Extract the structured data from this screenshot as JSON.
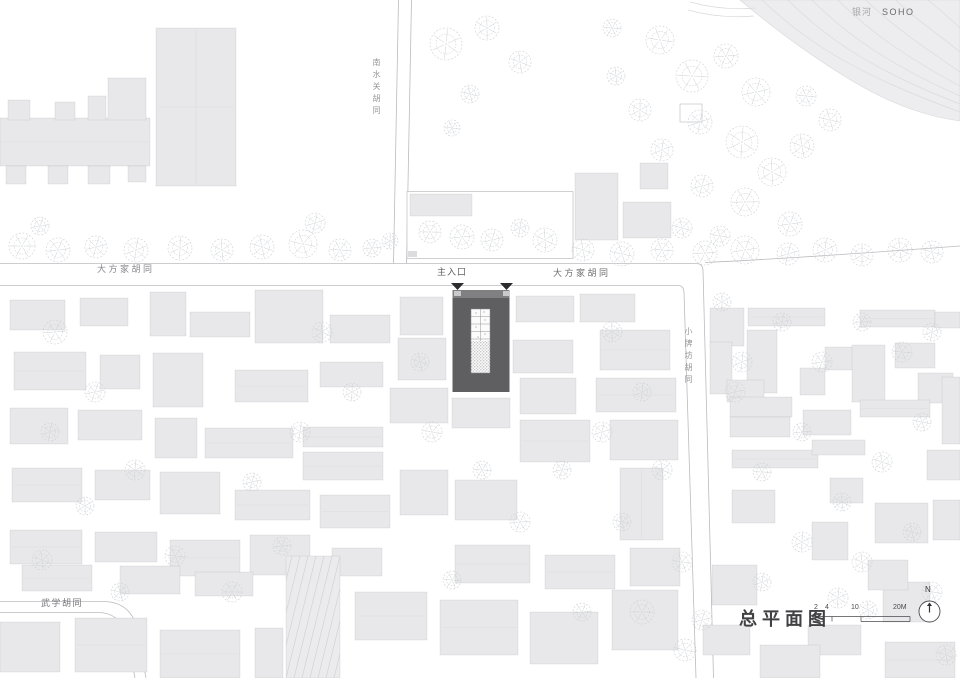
{
  "canvas": {
    "width": 960,
    "height": 678,
    "background": "#ffffff"
  },
  "labels": {
    "soho_cn": "银河",
    "soho_en": "SOHO",
    "street_top_vertical": "南水关胡同",
    "street_left": "大方家胡同",
    "main_entrance": "主入口",
    "street_right": "大方家胡同",
    "street_side_vertical": "小牌坊胡同",
    "street_bottom_left": "武学胡同",
    "title": "总平面图",
    "north": "N"
  },
  "scalebar": {
    "ticks": [
      "2",
      "4",
      "10",
      "20M"
    ]
  },
  "colors": {
    "building": "#e8e8ea",
    "building_stroke": "rgba(110,110,118,0.22)",
    "road_line": "#bcbcc0",
    "tree": "#cdd0d4",
    "site_fill": "#5f5f61",
    "site_top": "#808082",
    "entrance_arrow": "#2b2b2d",
    "courtyard": "#fbfbfb",
    "courtyard_line": "#88888a",
    "stipple_dot": "#8e8e90",
    "soho_fill": "#ededef",
    "soho_line": "#dbdbde",
    "parcel_stroke": "#c5c5c9",
    "hatch_line": "#d2d2d5",
    "annot": "#4a4a4e"
  },
  "map": {
    "roads": [
      "M0,263.5 H697",
      "M0,285.5 H679 Q683.5,286 684,292 L696,678",
      "M697,263.5 Q702.5,264 703,270 L713.5,678",
      "M705,262.5 C780,259 880,252 960,246",
      "M398.5,0 L393.5,263.5",
      "M411.5,0 L406.5,263.5",
      "M0,601.5 H104 Q128,602 136,624 L146,678",
      "M0,612.5 H99 Q118,613 126,632 L135,678"
    ],
    "soho": {
      "area": "M740,0 C790,42 838,74 872,92 C905,109 932,117 960,121 L960,0 Z",
      "lines": [
        "M762,0 C805,40 850,72 960,112",
        "M788,0 C826,38 872,70 960,104",
        "M812,0 C846,34 888,64 960,96",
        "M838,0 C868,30 904,56 960,86",
        "M866,0 C890,24 922,46 960,72",
        "M896,0 C914,18 938,34 960,52",
        "M928,0 C940,10 952,20 960,28",
        "M690,2 C712,8 734,10 756,8",
        "M688,10 C710,16 732,18 754,16"
      ]
    },
    "parcel": {
      "x": 407,
      "y": 191.5,
      "w": 166,
      "h": 67,
      "mark": [
        408,
        251,
        9,
        6
      ]
    },
    "outlined_buildings": [
      [
        680,
        104,
        22,
        18
      ]
    ],
    "hatch_building": {
      "x": 286,
      "y": 556,
      "w": 54,
      "h": 122
    },
    "buildings": [
      [
        156,
        28,
        80,
        158
      ],
      [
        0,
        118,
        150,
        48
      ],
      [
        8,
        100,
        22,
        20
      ],
      [
        55,
        102,
        20,
        18
      ],
      [
        88,
        96,
        18,
        24
      ],
      [
        108,
        78,
        38,
        42
      ],
      [
        6,
        166,
        20,
        18
      ],
      [
        48,
        166,
        20,
        18
      ],
      [
        88,
        166,
        22,
        18
      ],
      [
        128,
        166,
        18,
        16
      ],
      [
        410,
        194,
        62,
        22
      ],
      [
        575,
        173,
        43,
        67
      ],
      [
        623,
        202,
        48,
        36
      ],
      [
        640,
        163,
        28,
        26
      ],
      [
        10,
        300,
        55,
        30
      ],
      [
        80,
        298,
        48,
        28
      ],
      [
        150,
        292,
        36,
        44
      ],
      [
        190,
        312,
        60,
        25
      ],
      [
        255,
        290,
        68,
        53
      ],
      [
        330,
        315,
        60,
        28
      ],
      [
        400,
        297,
        43,
        38
      ],
      [
        398,
        338,
        48,
        42
      ],
      [
        14,
        352,
        72,
        38
      ],
      [
        100,
        355,
        40,
        34
      ],
      [
        153,
        353,
        50,
        54
      ],
      [
        235,
        370,
        73,
        32
      ],
      [
        320,
        362,
        63,
        25
      ],
      [
        390,
        388,
        58,
        35
      ],
      [
        10,
        408,
        58,
        36
      ],
      [
        78,
        410,
        64,
        30
      ],
      [
        155,
        418,
        42,
        40
      ],
      [
        205,
        428,
        88,
        30
      ],
      [
        303,
        427,
        80,
        20
      ],
      [
        303,
        452,
        80,
        28
      ],
      [
        12,
        468,
        70,
        34
      ],
      [
        95,
        470,
        55,
        30
      ],
      [
        160,
        472,
        60,
        42
      ],
      [
        235,
        490,
        75,
        30
      ],
      [
        320,
        495,
        70,
        33
      ],
      [
        400,
        470,
        48,
        45
      ],
      [
        10,
        530,
        72,
        34
      ],
      [
        95,
        532,
        62,
        30
      ],
      [
        170,
        540,
        70,
        36
      ],
      [
        250,
        535,
        60,
        40
      ],
      [
        332,
        548,
        50,
        28
      ],
      [
        22,
        565,
        70,
        26
      ],
      [
        120,
        566,
        60,
        28
      ],
      [
        195,
        572,
        58,
        24
      ],
      [
        0,
        622,
        60,
        50
      ],
      [
        75,
        618,
        72,
        54
      ],
      [
        160,
        630,
        80,
        48
      ],
      [
        255,
        628,
        28,
        50
      ],
      [
        355,
        592,
        72,
        48
      ],
      [
        440,
        600,
        78,
        55
      ],
      [
        530,
        612,
        68,
        52
      ],
      [
        612,
        590,
        66,
        60
      ],
      [
        516,
        296,
        58,
        26
      ],
      [
        580,
        294,
        55,
        28
      ],
      [
        513,
        340,
        60,
        33
      ],
      [
        520,
        378,
        56,
        36
      ],
      [
        600,
        330,
        70,
        40
      ],
      [
        596,
        378,
        80,
        34
      ],
      [
        610,
        420,
        68,
        40
      ],
      [
        520,
        420,
        70,
        42
      ],
      [
        620,
        468,
        43,
        72
      ],
      [
        455,
        480,
        62,
        40
      ],
      [
        455,
        545,
        75,
        38
      ],
      [
        545,
        555,
        70,
        34
      ],
      [
        630,
        548,
        50,
        38
      ],
      [
        452,
        398,
        58,
        30
      ],
      [
        710,
        308,
        34,
        38
      ],
      [
        748,
        308,
        77,
        18
      ],
      [
        860,
        310,
        75,
        17
      ],
      [
        935,
        312,
        25,
        16
      ],
      [
        710,
        342,
        22,
        52
      ],
      [
        747,
        330,
        30,
        63
      ],
      [
        825,
        347,
        30,
        23
      ],
      [
        852,
        345,
        33,
        57
      ],
      [
        895,
        343,
        40,
        25
      ],
      [
        918,
        373,
        35,
        30
      ],
      [
        942,
        377,
        18,
        67
      ],
      [
        727,
        380,
        37,
        22
      ],
      [
        800,
        368,
        25,
        27
      ],
      [
        730,
        397,
        62,
        20
      ],
      [
        803,
        410,
        48,
        25
      ],
      [
        730,
        417,
        60,
        20
      ],
      [
        860,
        400,
        70,
        17
      ],
      [
        732,
        450,
        86,
        18
      ],
      [
        732,
        490,
        43,
        33
      ],
      [
        812,
        440,
        53,
        15
      ],
      [
        830,
        478,
        33,
        25
      ],
      [
        875,
        503,
        53,
        40
      ],
      [
        812,
        522,
        36,
        38
      ],
      [
        883,
        582,
        47,
        40
      ],
      [
        808,
        625,
        53,
        30
      ],
      [
        927,
        450,
        33,
        30
      ],
      [
        933,
        500,
        27,
        40
      ],
      [
        703,
        625,
        47,
        30
      ],
      [
        712,
        565,
        45,
        40
      ],
      [
        760,
        645,
        60,
        33
      ],
      [
        885,
        642,
        70,
        36
      ],
      [
        868,
        560,
        40,
        30
      ]
    ],
    "trees": [
      [
        22,
        246,
        13
      ],
      [
        58,
        250,
        12
      ],
      [
        96,
        247,
        11
      ],
      [
        136,
        250,
        12
      ],
      [
        180,
        248,
        12
      ],
      [
        222,
        250,
        11
      ],
      [
        262,
        247,
        12
      ],
      [
        303,
        244,
        14
      ],
      [
        340,
        250,
        11
      ],
      [
        372,
        248,
        9
      ],
      [
        40,
        226,
        9
      ],
      [
        315,
        223,
        10
      ],
      [
        446,
        44,
        16
      ],
      [
        487,
        28,
        12
      ],
      [
        520,
        62,
        11
      ],
      [
        470,
        94,
        9
      ],
      [
        452,
        128,
        8
      ],
      [
        430,
        232,
        11
      ],
      [
        462,
        237,
        12
      ],
      [
        492,
        240,
        11
      ],
      [
        520,
        228,
        9
      ],
      [
        390,
        241,
        8
      ],
      [
        545,
        240,
        12
      ],
      [
        583,
        250,
        11
      ],
      [
        622,
        254,
        12
      ],
      [
        662,
        250,
        11
      ],
      [
        705,
        253,
        12
      ],
      [
        745,
        250,
        14
      ],
      [
        788,
        254,
        11
      ],
      [
        825,
        250,
        12
      ],
      [
        862,
        255,
        11
      ],
      [
        900,
        250,
        12
      ],
      [
        932,
        252,
        11
      ],
      [
        660,
        40,
        14
      ],
      [
        692,
        76,
        16
      ],
      [
        726,
        56,
        12
      ],
      [
        756,
        92,
        14
      ],
      [
        700,
        122,
        12
      ],
      [
        742,
        142,
        16
      ],
      [
        772,
        172,
        14
      ],
      [
        802,
        146,
        12
      ],
      [
        830,
        120,
        11
      ],
      [
        806,
        96,
        10
      ],
      [
        745,
        202,
        14
      ],
      [
        790,
        224,
        12
      ],
      [
        702,
        186,
        11
      ],
      [
        662,
        150,
        11
      ],
      [
        640,
        110,
        11
      ],
      [
        616,
        76,
        9
      ],
      [
        682,
        228,
        10
      ],
      [
        720,
        236,
        10
      ],
      [
        612,
        28,
        9
      ],
      [
        55,
        332,
        12
      ],
      [
        95,
        392,
        10
      ],
      [
        50,
        432,
        9
      ],
      [
        135,
        470,
        10
      ],
      [
        85,
        506,
        9
      ],
      [
        42,
        560,
        10
      ],
      [
        120,
        592,
        9
      ],
      [
        175,
        556,
        10
      ],
      [
        232,
        592,
        10
      ],
      [
        282,
        546,
        9
      ],
      [
        252,
        482,
        9
      ],
      [
        300,
        432,
        10
      ],
      [
        352,
        392,
        9
      ],
      [
        322,
        332,
        10
      ],
      [
        420,
        362,
        9
      ],
      [
        432,
        432,
        10
      ],
      [
        482,
        470,
        9
      ],
      [
        520,
        522,
        10
      ],
      [
        562,
        470,
        9
      ],
      [
        602,
        432,
        10
      ],
      [
        642,
        392,
        9
      ],
      [
        612,
        332,
        10
      ],
      [
        662,
        470,
        10
      ],
      [
        622,
        522,
        9
      ],
      [
        682,
        562,
        10
      ],
      [
        642,
        612,
        12
      ],
      [
        582,
        612,
        9
      ],
      [
        702,
        620,
        10
      ],
      [
        762,
        582,
        9
      ],
      [
        802,
        542,
        10
      ],
      [
        842,
        502,
        9
      ],
      [
        882,
        462,
        10
      ],
      [
        922,
        422,
        9
      ],
      [
        902,
        352,
        10
      ],
      [
        862,
        322,
        9
      ],
      [
        822,
        362,
        10
      ],
      [
        782,
        322,
        9
      ],
      [
        742,
        362,
        10
      ],
      [
        722,
        302,
        9
      ],
      [
        862,
        562,
        10
      ],
      [
        912,
        532,
        9
      ],
      [
        932,
        592,
        10
      ],
      [
        762,
        472,
        9
      ],
      [
        802,
        432,
        9
      ],
      [
        735,
        392,
        10
      ],
      [
        932,
        332,
        9
      ],
      [
        838,
        598,
        10
      ],
      [
        868,
        610,
        9
      ],
      [
        946,
        655,
        10
      ],
      [
        685,
        650,
        11
      ],
      [
        452,
        580,
        9
      ]
    ],
    "site": {
      "x": 452.5,
      "y": 290,
      "w": 57,
      "h": 102,
      "arrows": [
        [
          451,
          283,
          13,
          7
        ],
        [
          500,
          283,
          13,
          7
        ]
      ],
      "door_marks": [
        [
          454,
          291,
          7,
          5
        ],
        [
          503,
          291,
          7,
          5
        ]
      ],
      "courtyard": {
        "x": 471,
        "y": 309,
        "w": 19,
        "h": 64
      },
      "room_lines_y": [
        316.5,
        324,
        331.5,
        339
      ],
      "planting": {
        "x": 471,
        "y": 341,
        "w": 19,
        "h": 32
      }
    },
    "scalebar_geom": {
      "x0": 813,
      "x1": 910,
      "y": 616.5,
      "drop": 5,
      "ticks_x": [
        813,
        823,
        832,
        861,
        910
      ],
      "boxes": [
        [
          813,
          823
        ],
        [
          861,
          910
        ]
      ]
    },
    "north_arrow": {
      "cx": 929.5,
      "cy": 611.5,
      "r": 10.5
    }
  }
}
